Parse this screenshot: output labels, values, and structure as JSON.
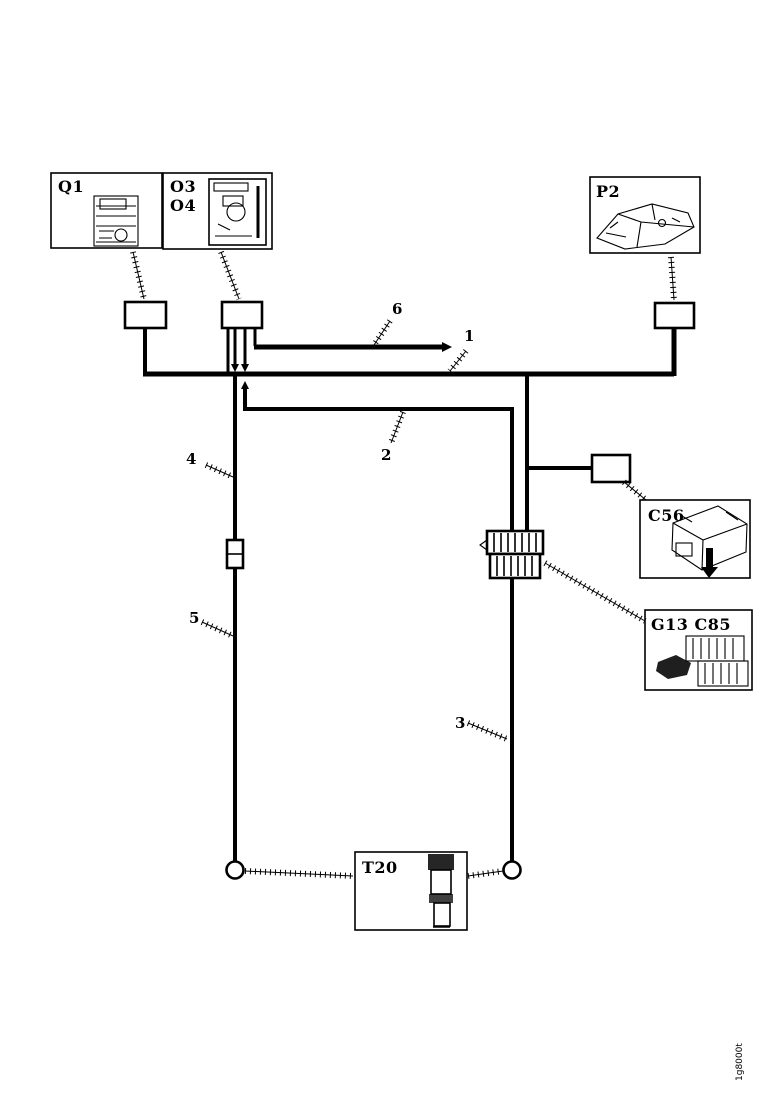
{
  "colors": {
    "ink": "#000000",
    "paper": "#ffffff"
  },
  "components": {
    "q1": {
      "label": "Q1"
    },
    "o3o4": {
      "label_top": "O3",
      "label_bottom": "O4"
    },
    "p2": {
      "label": "P2"
    },
    "c56": {
      "label": "C56"
    },
    "g13_c85": {
      "label": "G13 C85"
    },
    "t20": {
      "label": "T20"
    }
  },
  "wire_labels": {
    "w1": "1",
    "w2": "2",
    "w3": "3",
    "w4": "4",
    "w5": "5",
    "w6": "6"
  },
  "footer": {
    "doc_code": "1g8000t"
  }
}
